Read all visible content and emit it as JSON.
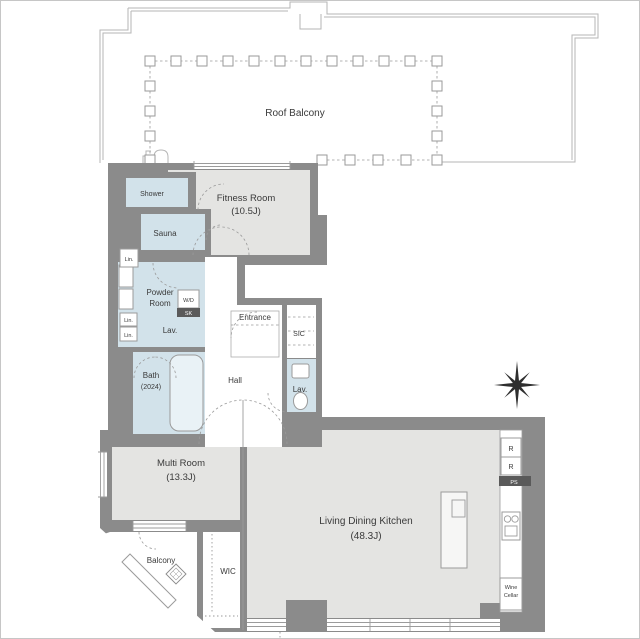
{
  "rooms": {
    "roof_balcony": "Roof Balcony",
    "fitness": {
      "name": "Fitness Room",
      "area": "(10.5J)"
    },
    "shower": "Shower",
    "sauna": "Sauna",
    "powder_line1": "Powder",
    "powder_line2": "Room",
    "lav_powder": "Lav.",
    "bath": {
      "name": "Bath",
      "size": "(2024)"
    },
    "hall": "Hall",
    "entrance": "Entrance",
    "sic": "SIC",
    "lav_toilet": "Lav.",
    "multi": {
      "name": "Multi Room",
      "area": "(13.3J)"
    },
    "balcony": "Balcony",
    "wic": "WIC",
    "ldk": {
      "name": "Living Dining Kitchen",
      "area": "(48.3J)"
    }
  },
  "fixtures": {
    "lin1": "Lin.",
    "lin2": "Lin.",
    "lin3": "Lin.",
    "wd": "W/D",
    "sk": "SK",
    "r1": "R",
    "r2": "R",
    "ps": "PS",
    "wine_line1": "Wine",
    "wine_line2": "Cellar"
  },
  "icons": {
    "compass": "compass-rose-icon",
    "stove": "cooktop-icon",
    "toilet": "toilet-icon",
    "bathtub": "bathtub-icon",
    "kitchen_island": "kitchen-island-icon",
    "evacuation_hatch": "evacuation-hatch-icon",
    "utility_sink": "utility-sink-icon"
  },
  "colors": {
    "wall": "#8b8b8b",
    "floor": "#e4e4e2",
    "wet_area": "#d2e2ea",
    "outline": "#9b9b9b",
    "text": "#3a3a3a",
    "badge": "#5a5a5a"
  }
}
